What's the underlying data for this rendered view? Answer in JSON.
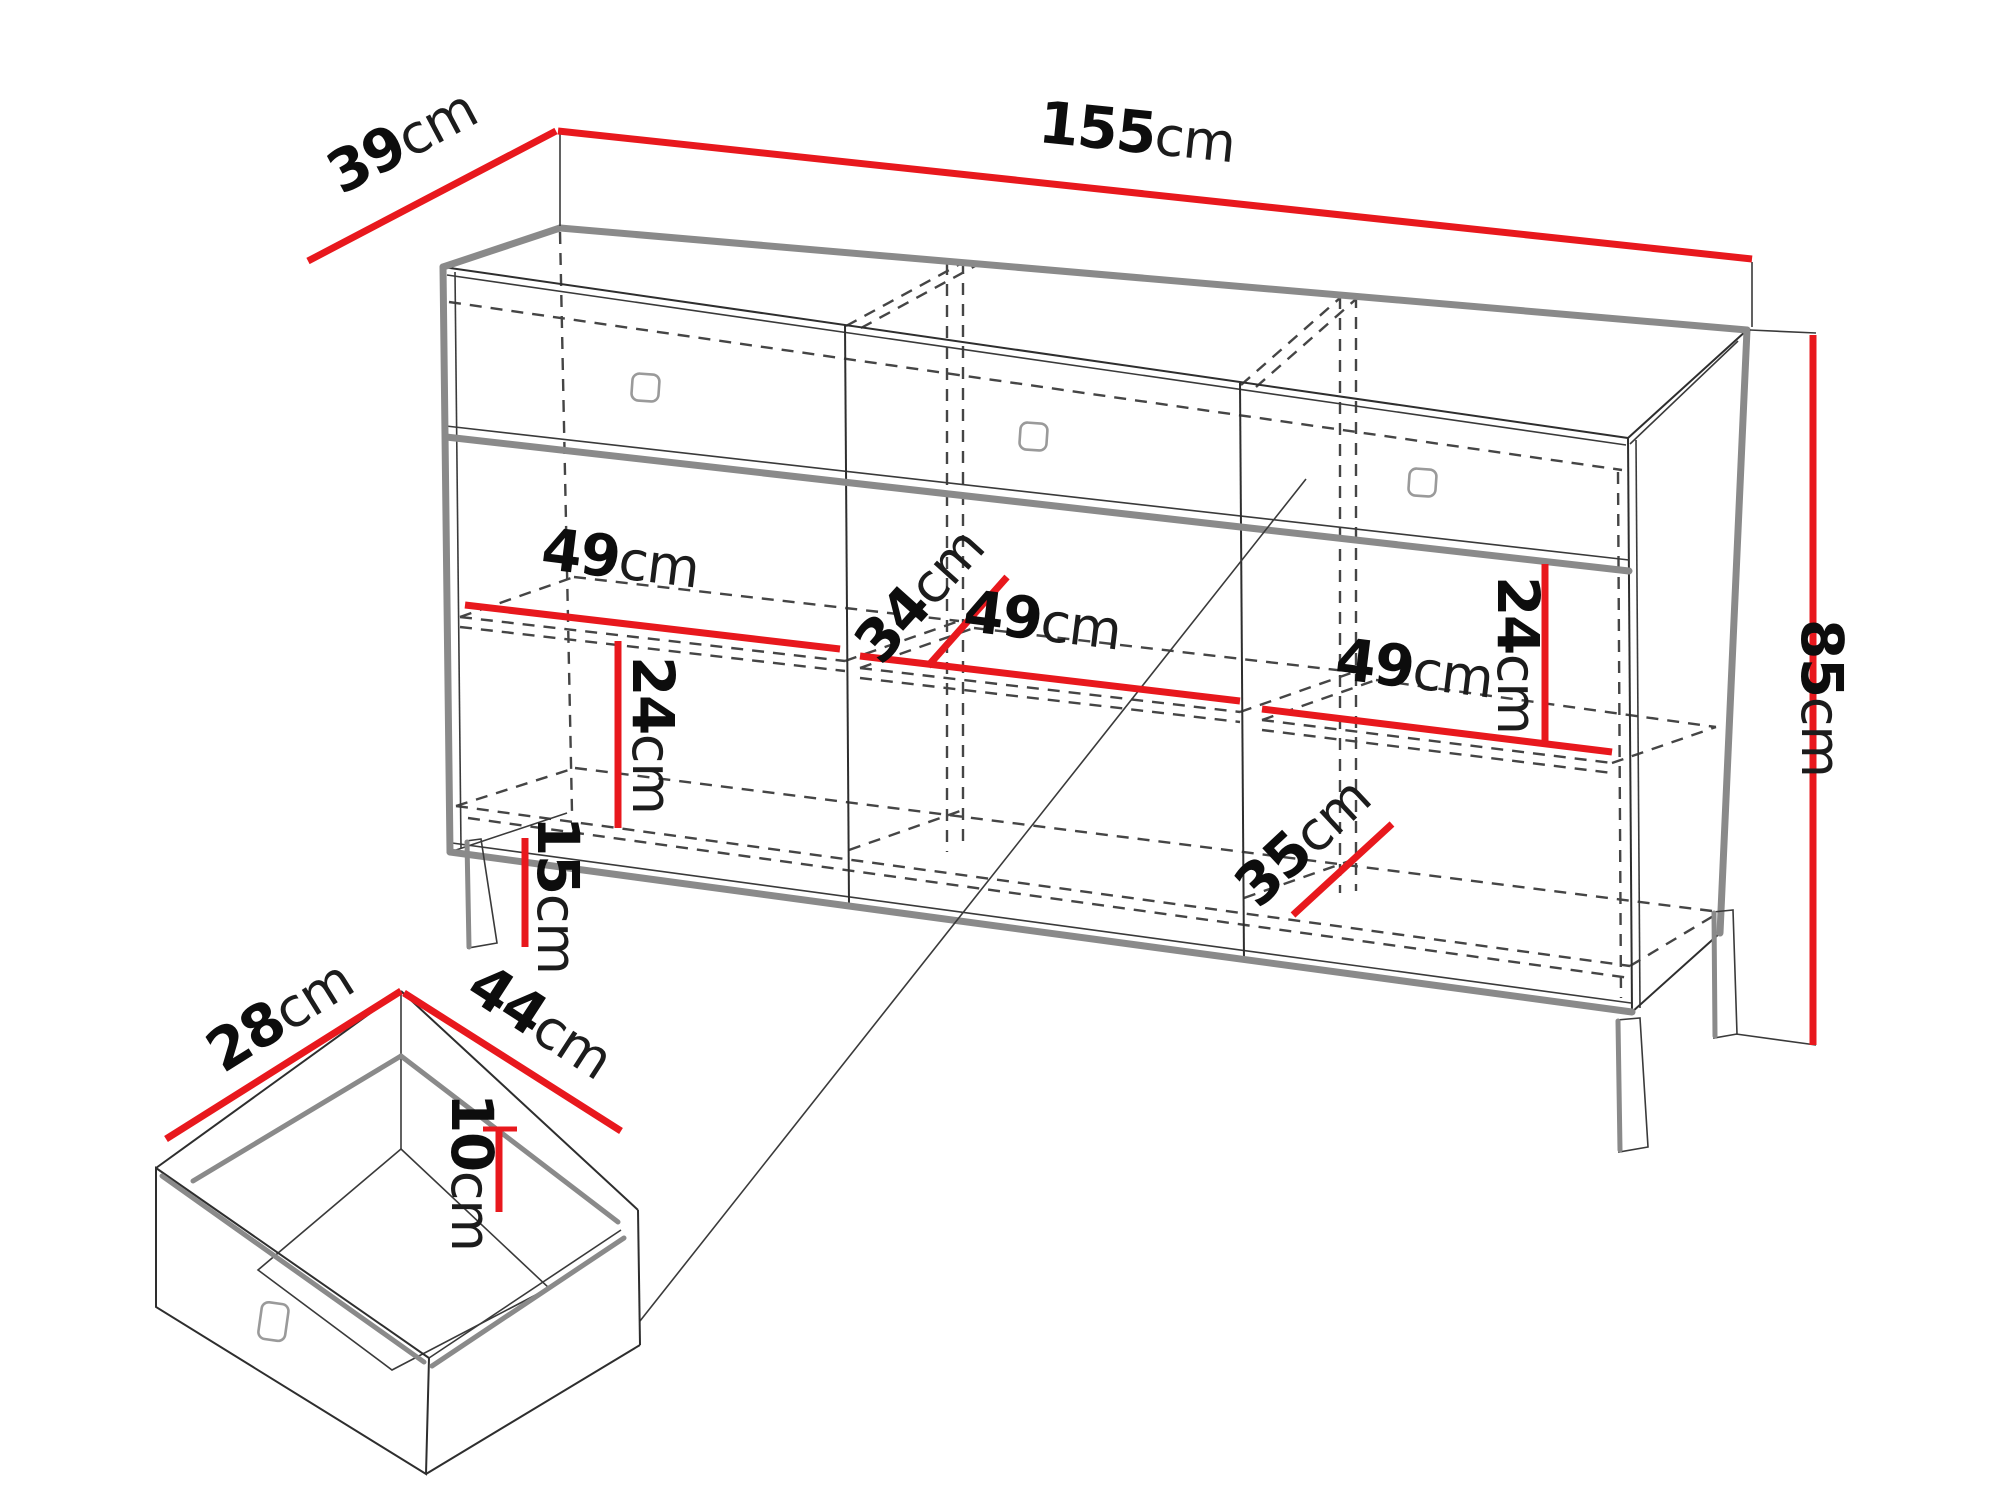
{
  "diagram": {
    "type": "furniture-dimension-drawing",
    "subject": "sideboard cabinet with three drawers, shelves, metal legs and drawer detail view",
    "unit": "cm",
    "accent_color": "#e8181d",
    "line_color": "#2e2e2e",
    "silhouette_color": "#8a8a8a",
    "dimensions": {
      "total_width": {
        "num": "155",
        "unit": "cm"
      },
      "total_depth": {
        "num": "39",
        "unit": "cm"
      },
      "total_height": {
        "num": "85",
        "unit": "cm"
      },
      "compartment1_width": {
        "num": "49",
        "unit": "cm"
      },
      "compartment2_width": {
        "num": "49",
        "unit": "cm"
      },
      "compartment3_width": {
        "num": "49",
        "unit": "cm"
      },
      "shelf_depth": {
        "num": "34",
        "unit": "cm"
      },
      "compartment1_shelf_height": {
        "num": "24",
        "unit": "cm"
      },
      "compartment3_shelf_height": {
        "num": "24",
        "unit": "cm"
      },
      "bottom_shelf_depth": {
        "num": "35",
        "unit": "cm"
      },
      "leg_height": {
        "num": "15",
        "unit": "cm"
      },
      "drawer_depth": {
        "num": "28",
        "unit": "cm"
      },
      "drawer_width": {
        "num": "44",
        "unit": "cm"
      },
      "drawer_inner_height": {
        "num": "10",
        "unit": "cm"
      }
    }
  }
}
